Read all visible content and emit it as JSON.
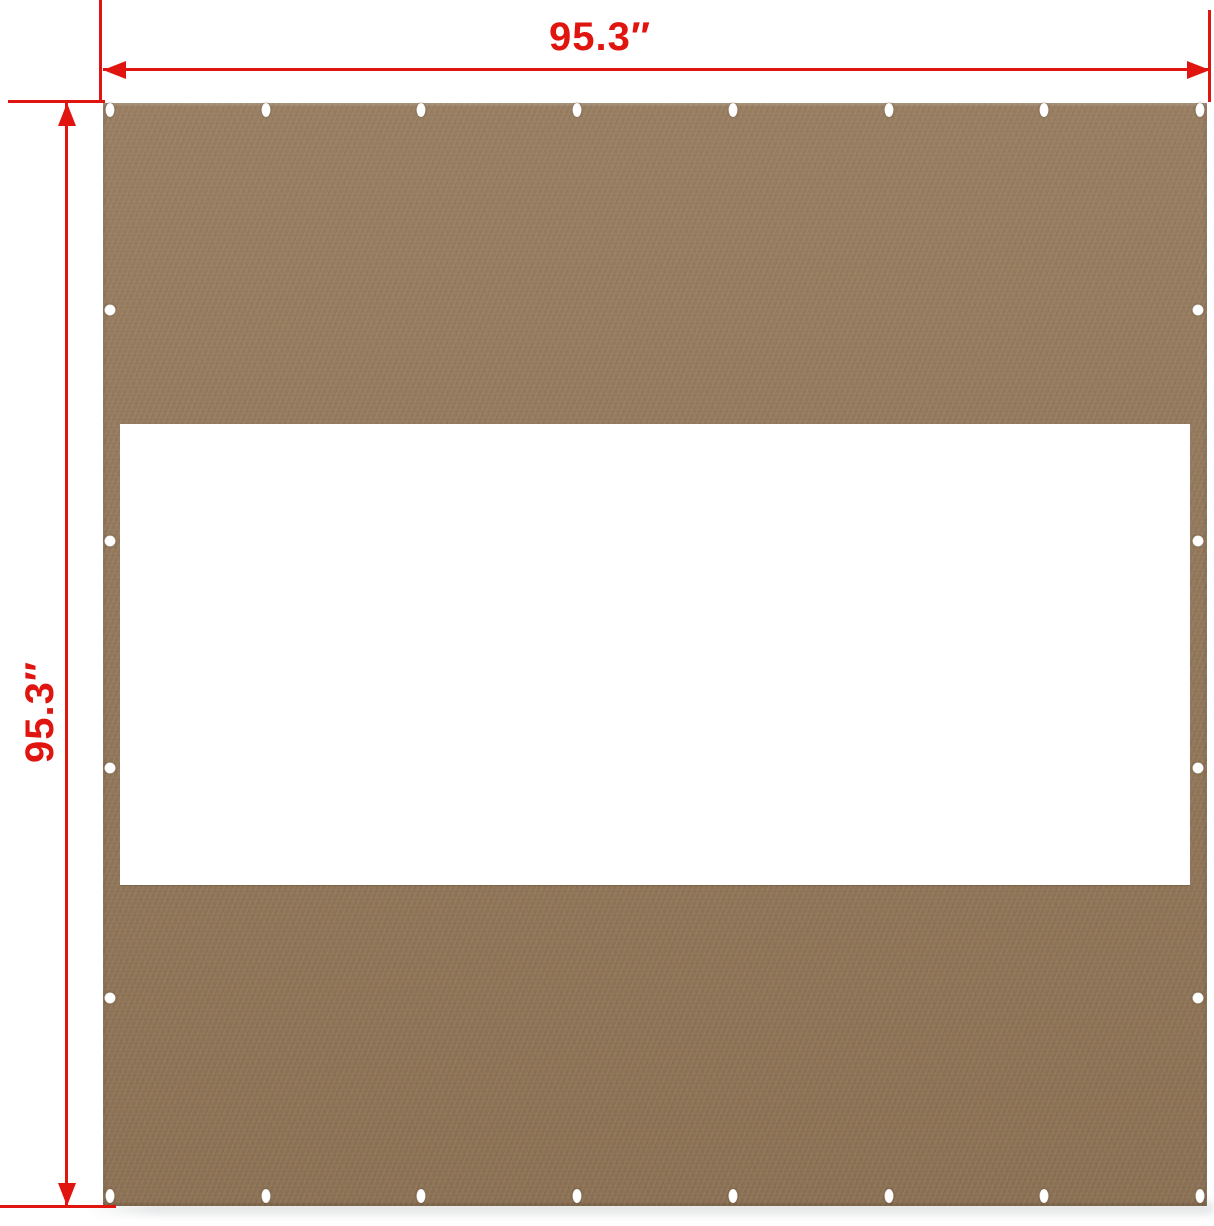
{
  "diagram": {
    "width_label": "95.3″",
    "height_label": "95.3″",
    "grommets": {
      "top_row": 8,
      "bottom_row": 8,
      "left_column_middle": 4,
      "right_column_middle": 4
    }
  },
  "colors": {
    "dimension_red": "#e01510",
    "panel_brown": "#92775a",
    "panel_brown_light": "#987d60",
    "panel_brown_dark": "#8a6f52",
    "window_white": "#ffffff",
    "grommet_white": "#ffffff",
    "background_white": "#ffffff",
    "ground_shadow": "#e6e8e9"
  }
}
